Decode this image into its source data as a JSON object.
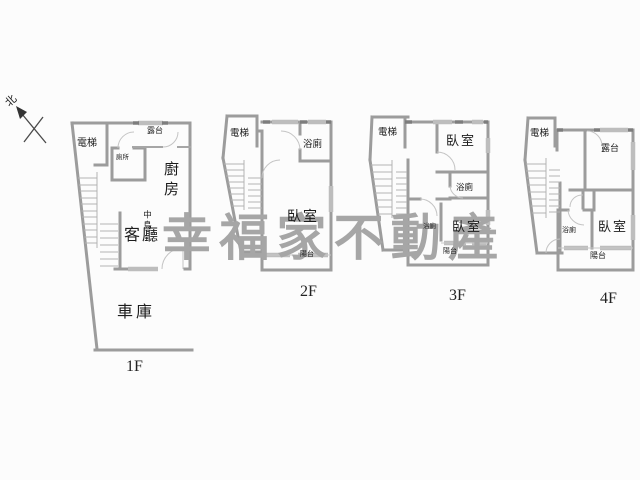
{
  "compass": {
    "north": "北"
  },
  "watermark": {
    "text": "幸福家不動產",
    "chars": [
      "幸",
      "福",
      "家",
      "不",
      "動",
      "產"
    ],
    "color": "#a6a6a6"
  },
  "plan": {
    "wall_color": "#9c9c9c",
    "label_color": "#1c1c1c"
  },
  "floors": {
    "f1": {
      "label": "1F",
      "rooms": {
        "elevator": "電梯",
        "toilet": "廁所",
        "terrace": "露台",
        "kitchen": "廚房",
        "island": "中島",
        "living": "客廳",
        "garage": "車庫"
      }
    },
    "f2": {
      "label": "2F",
      "rooms": {
        "elevator": "電梯",
        "bath": "浴廁",
        "bedroom": "臥室",
        "balcony": "陽台"
      }
    },
    "f3": {
      "label": "3F",
      "rooms": {
        "elevator": "電梯",
        "bedroom_upper": "臥室",
        "bath_upper": "浴廁",
        "bath_lower": "浴廁",
        "bedroom_lower": "臥室",
        "balcony": "陽台"
      }
    },
    "f4": {
      "label": "4F",
      "rooms": {
        "elevator": "電梯",
        "terrace": "露台",
        "bath": "浴廁",
        "bedroom": "臥室",
        "balcony": "陽台"
      }
    }
  }
}
